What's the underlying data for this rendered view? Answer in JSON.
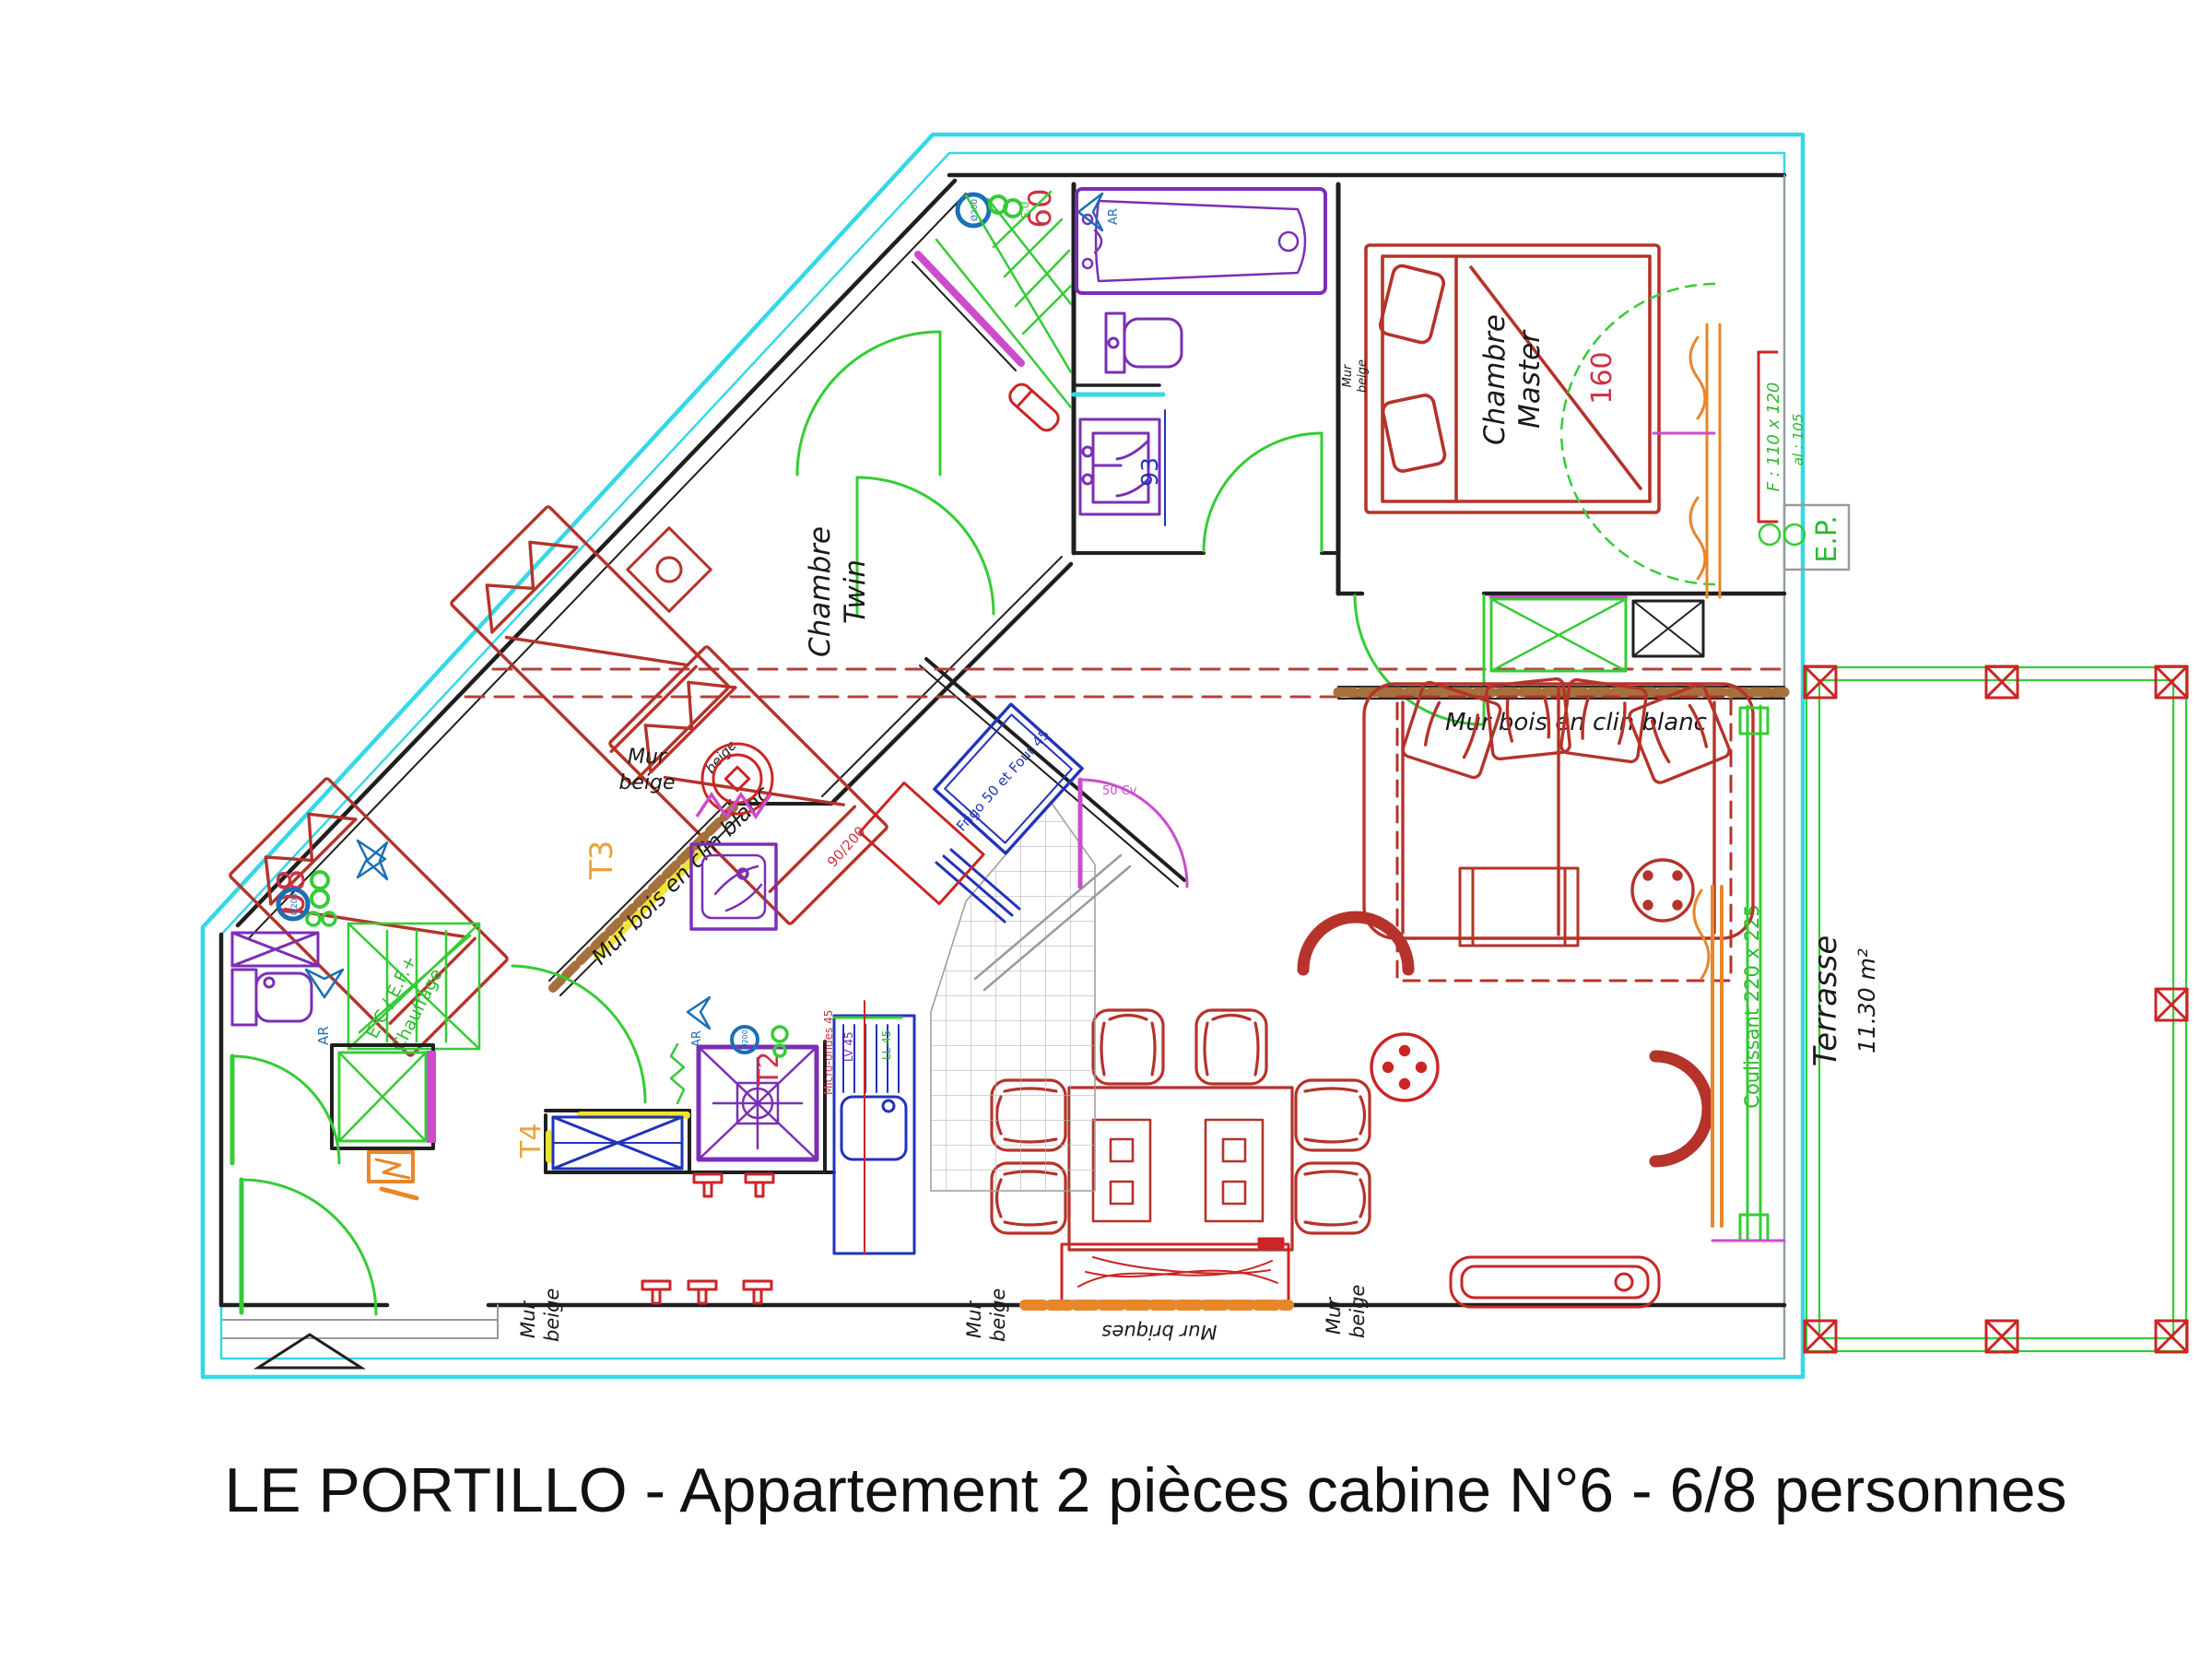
{
  "title": "LE PORTILLO - Appartement 2 pièces cabine N°6 - 6/8 personnes",
  "colors": {
    "exterior_wall": "#35d8e6",
    "furniture": "#b5332a",
    "fixtures": "#7a2fb5",
    "doors": "#35cc35",
    "wood_wall": "#a6703d",
    "brick_wall": "#e8862a",
    "dimension_blue": "#2233bb",
    "zone_tag_orange": "#e8a33d"
  },
  "rooms": {
    "master": {
      "line1": "Chambre",
      "line2": "Master",
      "bed_width": "160"
    },
    "twin": {
      "line1": "Chambre",
      "line2": "Twin",
      "bed_dim": "90/200"
    },
    "terrasse": {
      "name": "Terrasse",
      "area": "11.30 m²"
    }
  },
  "walls": {
    "mur": "Mur",
    "beige": "beige",
    "mur_bois": "Mur bois en clin blanc",
    "mur_briques": "Mur briques"
  },
  "openings": {
    "coulissant": "Coulissant 220 x 225",
    "window_f": "F : 110 x 120",
    "window_allege": "al : 105",
    "door_width": "50 Cv"
  },
  "equipment": {
    "ep": "E.P.",
    "eu": "E.U.",
    "diam": "Ø200",
    "duct_60": "60",
    "duct_08": "08",
    "ecef": "E.C / E.F.+",
    "chauffage": "Chauffage",
    "ar": "AR",
    "frigo_four": "Frigo 50 et Four 45",
    "micro_ondes": "Micro-ondes 45",
    "lave_vaisselle": "LV 45",
    "lave_linge": "LL 45",
    "dim_93": "93"
  },
  "zones": {
    "t2": "T2",
    "t3": "T3",
    "t4": "T4"
  }
}
